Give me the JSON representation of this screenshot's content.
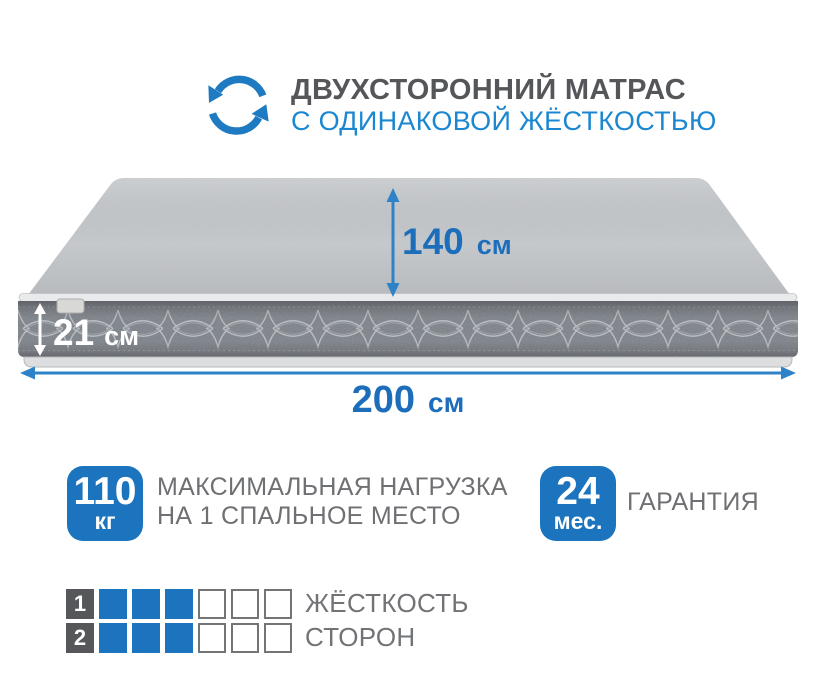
{
  "header": {
    "icon": "two-sided-rotate-icon",
    "line1": "ДВУХСТОРОННИЙ МАТРАС",
    "line2": "С ОДИНАКОВОЙ ЖЁСТКОСТЬЮ"
  },
  "mattress": {
    "width": {
      "value": "140",
      "unit": "см"
    },
    "height": {
      "value": "21",
      "unit": "см"
    },
    "length": {
      "value": "200",
      "unit": "см"
    }
  },
  "badges": [
    {
      "value": "110",
      "unit": "кг",
      "label_line1": "МАКСИМАЛЬНАЯ НАГРУЗКА",
      "label_line2": "НА 1 СПАЛЬНОЕ МЕСТО"
    },
    {
      "value": "24",
      "unit": "мес.",
      "label_line1": "ГАРАНТИЯ"
    }
  ],
  "firmness": {
    "rows": [
      {
        "label": "1",
        "filled": 3,
        "total": 6
      },
      {
        "label": "2",
        "filled": 3,
        "total": 6
      }
    ],
    "caption_line1": "ЖЁСТКОСТЬ",
    "caption_line2": "СТОРОН"
  },
  "colors": {
    "accent_blue": "#1b74bd",
    "heading_blue": "#1a87d0",
    "dimension_blue": "#1d6eba",
    "arrow_blue": "#2e83c8",
    "dark_text": "#55565a",
    "gray_text": "#6e7073",
    "fabric_gray": "#c7cacd",
    "band_gray": "#767b82"
  }
}
